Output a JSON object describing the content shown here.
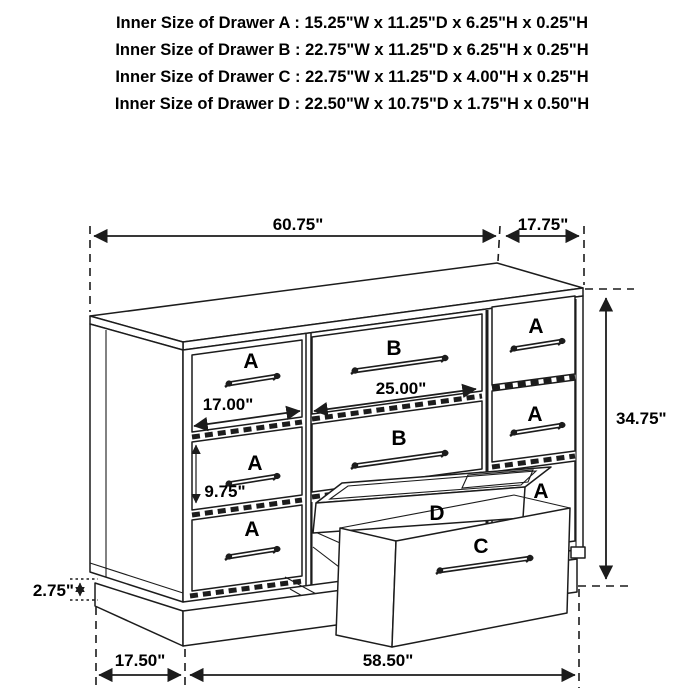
{
  "spec_header": {
    "lines": [
      "Inner Size of Drawer A : 15.25\"W x 11.25\"D x 6.25\"H x 0.25\"H",
      "Inner Size of Drawer B : 22.75\"W x 11.25\"D x 6.25\"H x 0.25\"H",
      "Inner Size of Drawer C : 22.75\"W x 11.25\"D x 4.00\"H x 0.25\"H",
      "Inner Size of Drawer D : 22.50\"W x 10.75\"D x 1.75\"H x 0.50\"H"
    ]
  },
  "diagram": {
    "dimensions": {
      "top_left_width": "60.75\"",
      "top_right_width": "17.75\"",
      "overall_height": "34.75\"",
      "middle_drawer_width": "25.00\"",
      "left_drawer_width": "17.00\"",
      "left_drawer_height": "9.75\"",
      "base_height": "2.75\"",
      "side_depth": "17.50\"",
      "front_width": "58.50\""
    },
    "drawer_labels": {
      "a": "A",
      "b": "B",
      "c": "C",
      "d": "D"
    },
    "colors": {
      "drawer_label": "#e62129",
      "line": "#1c1c1c",
      "background": "#ffffff"
    }
  }
}
